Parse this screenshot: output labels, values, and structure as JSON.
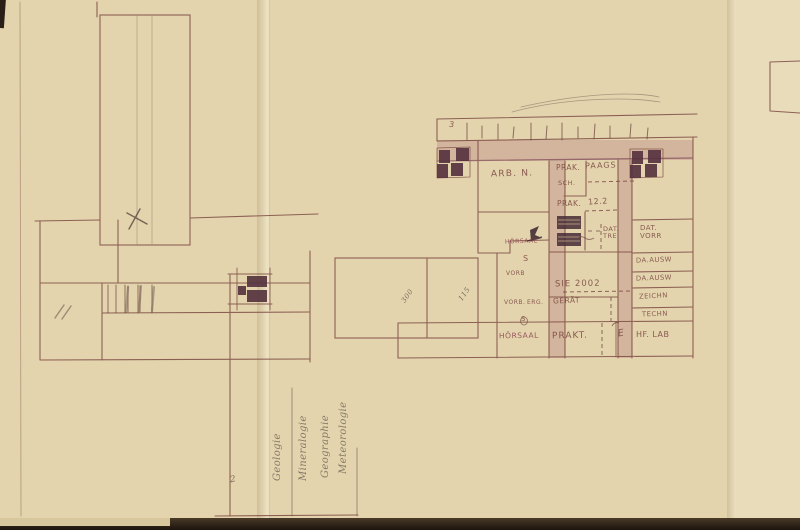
{
  "drawing": {
    "type": "hand-drawn architectural floor plan sketch",
    "rooms": {
      "arb_n": "ARB. N.",
      "prak_upper": "PRAK.",
      "paags": "PAAGS",
      "sch": "SCH.",
      "prak_lower": "PRAK.",
      "room_12_2": "12.2",
      "dat_tre": "DAT.\nTRE",
      "dat_vorr": "DAT.\nVORR",
      "da_ausw_1": "DA.AUSW",
      "da_ausw_2": "DA.AUSW",
      "zeichn": "ZEICHN",
      "techn": "TECHN",
      "hf_lab": "HF. LAB",
      "hoersaal_upper": "HÖRSAAL",
      "s_room": "S",
      "vorb_upper": "VORB",
      "vorb_lower": "VORB.",
      "erg": "ERG.",
      "s_mark": "S",
      "sie_2002": "SIE 2002",
      "geraet": "GERÄT",
      "hoersaal_main": "HÖRSAAL",
      "prakt": "PRAKT.",
      "e_room": "E"
    },
    "annotations": {
      "tick_3": "3",
      "dim_left": "300",
      "dim_right": "115",
      "mark_2": "2"
    },
    "handwriting": {
      "line_1": "Geologie",
      "line_2": "Mineralogie",
      "line_3": "Geographie",
      "line_4": "Meteorologie"
    },
    "colors": {
      "paper": "#e3d4ae",
      "ink": "#7a463f",
      "corridor_fill": "#a8626c",
      "checker_fill": "#55313e",
      "pencil": "#6a5c4e",
      "photo_background": "#20170f"
    }
  }
}
